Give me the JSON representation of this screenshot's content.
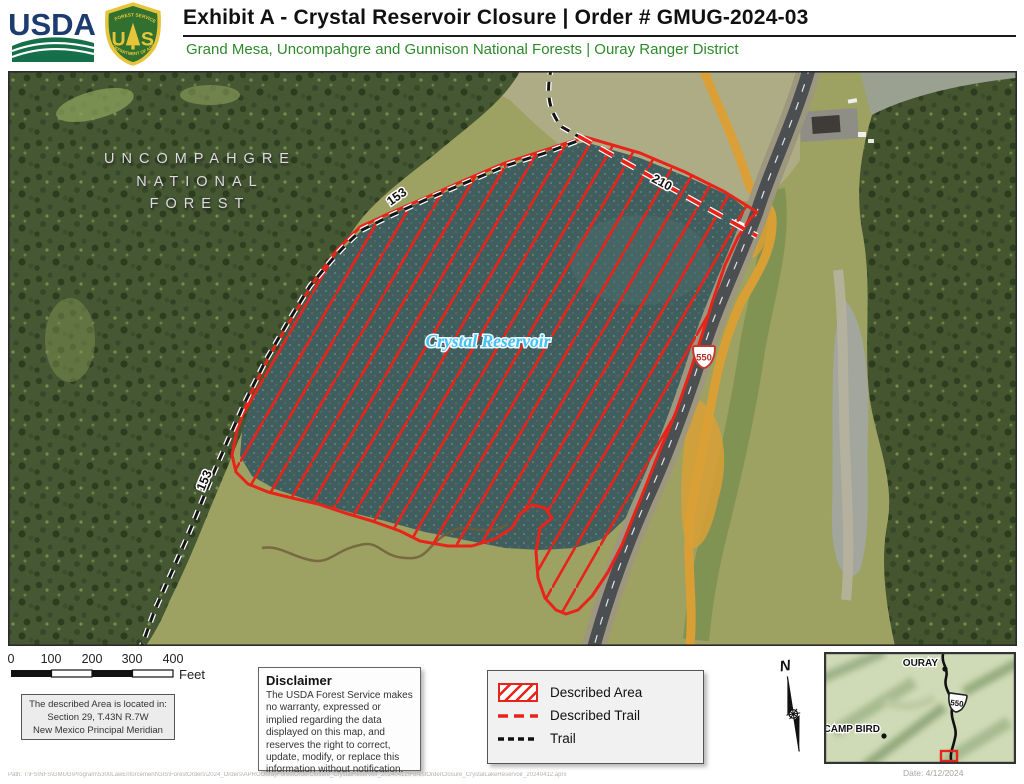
{
  "header": {
    "title": "Exhibit A - Crystal Reservoir Closure | Order #  GMUG-2024-03",
    "subtitle": "Grand Mesa, Uncompahgre and Gunnison National Forests | Ouray Ranger District",
    "usda_wordmark": "USDA",
    "fs_shield": {
      "top_arc": "FOREST SERVICE",
      "bottom_arc": "DEPARTMENT OF AGRICULTURE",
      "monogram_left": "U",
      "monogram_right": "S"
    }
  },
  "map": {
    "forest_label": {
      "line1": "UNCOMPAHGRE",
      "line2": "NATIONAL",
      "line3": "FOREST"
    },
    "reservoir_label": "Crystal Reservoir",
    "trail_153": "153",
    "trail_210": "210",
    "highway_550": "550"
  },
  "scale_bar": {
    "ticks": [
      "0",
      "100",
      "200",
      "300",
      "400"
    ],
    "unit": "Feet"
  },
  "location_box": {
    "line1": "The described Area is located in:",
    "line2": "Section 29, T.43N R.7W",
    "line3": "New Mexico Principal Meridian"
  },
  "disclaimer": {
    "title": "Disclaimer",
    "body": "The USDA Forest Service makes no warranty, expressed or implied regarding the data displayed on this map, and reserves the right to correct, update, modify, or replace this information without notification."
  },
  "legend": {
    "items": [
      {
        "label": "Described Area"
      },
      {
        "label": "Described Trail"
      },
      {
        "label": "Trail"
      }
    ]
  },
  "north_arrow": {
    "label": "N"
  },
  "inset": {
    "city": "OURAY",
    "place": "CAMP BIRD",
    "highway": "550"
  },
  "footer": {
    "path": "Path: T:\\FS\\NFS\\GMUG\\Program\\5300LawEnforcement\\GIS\\ForestOrders\\2024_Orders\\APROOurayForestOrderClosure_CrystalReservoir_20240412\\ForestOrderClosure_CrystalLakeReservoir_20240412.aprx",
    "date": "Date: 4/12/2024"
  },
  "colors": {
    "closure_red": "#e8231a",
    "subtitle_green": "#2e8b2a",
    "usda_blue": "#1c3b6e",
    "shield_green": "#31702e",
    "shield_gold": "#e7c53a",
    "water_teal": "#415e5e",
    "reservoir_label_blue": "#45c0f0"
  }
}
